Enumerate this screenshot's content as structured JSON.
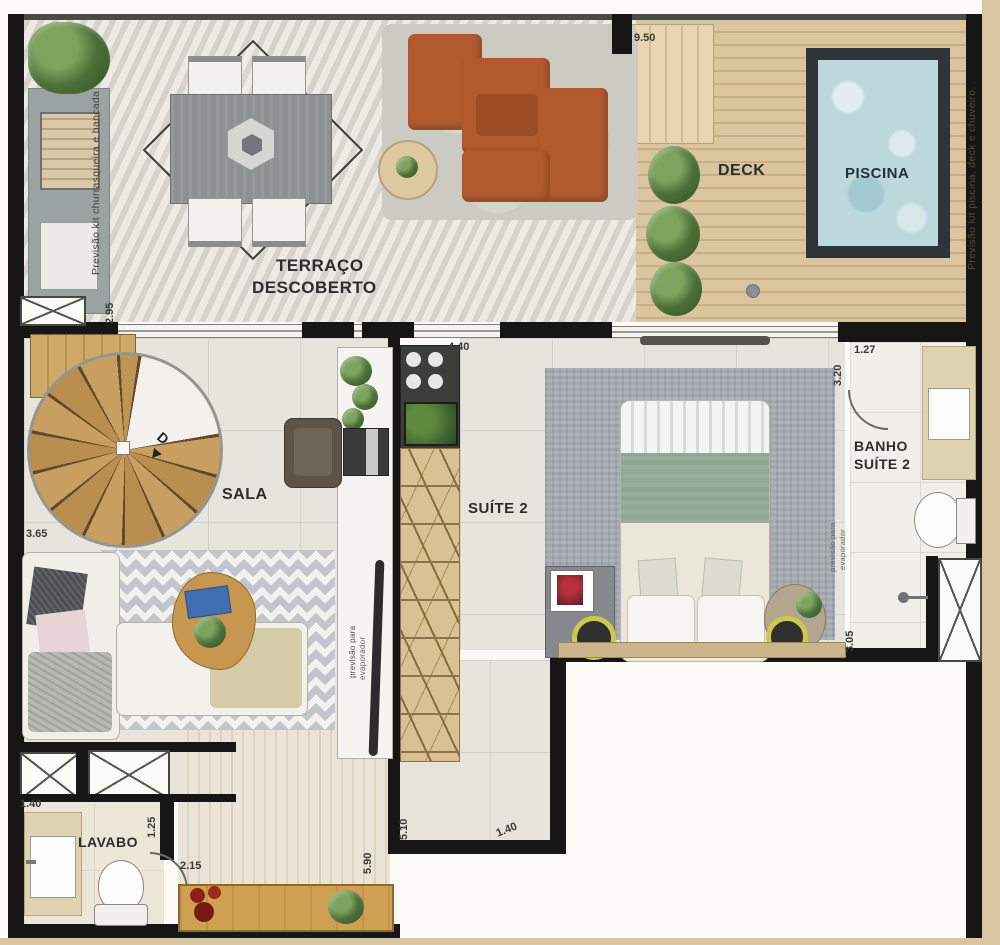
{
  "rooms": {
    "terrace_line1": "TERRAÇO",
    "terrace_line2": "DESCOBERTO",
    "deck": "DECK",
    "pool": "PISCINA",
    "sala": "SALA",
    "suite2": "SUÍTE 2",
    "banho_line1": "BANHO",
    "banho_line2": "SUÍTE 2",
    "lavabo": "LAVABO"
  },
  "notes": {
    "left_margin": "Previsão kit churrasqueira e bancada",
    "right_margin": "Previsão kit piscina, deck e chuveiro.",
    "island_prevision_line1": "previsão para",
    "island_prevision_line2": "evaporador",
    "suite_prevision_line1": "previsão para",
    "suite_prevision_line2": "evaporador",
    "stair_direction": "D"
  },
  "dimensions": {
    "deck_width": "9.50",
    "sala_opening": "2.95",
    "suite_width": "4.40",
    "banho_entry": "1.27",
    "banho_length": "3.20",
    "sala_width": "3.65",
    "banho_lower": "3.05",
    "lavabo_width": "1.40",
    "lavabo_depth": "1.25",
    "hall_width": "2.15",
    "hall_length": "5.90",
    "corridor_length": "5.10",
    "corridor_width": "1.40"
  },
  "colors": {
    "wall": "#161616",
    "deck_wood": "#d8c29b",
    "pool_water": "#bdd8dd",
    "stair_wood": "#c79e5e",
    "sofa_rust": "#b05a2e",
    "margin_tan": "#d8c6a3"
  }
}
